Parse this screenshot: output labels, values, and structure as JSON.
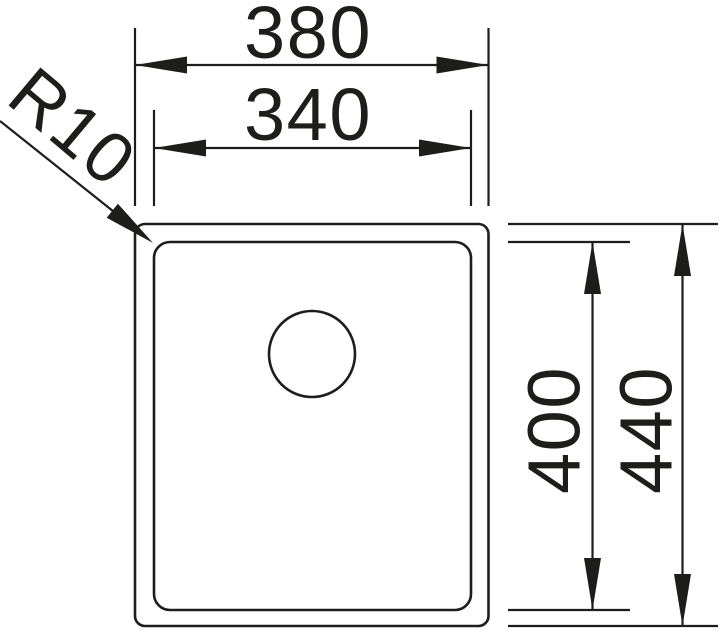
{
  "diagram": {
    "name": "sink-cutout-dimension-drawing",
    "dimensions": {
      "outer_width": "380",
      "inner_width": "340",
      "inner_height": "400",
      "outer_height": "440",
      "corner_radius": "R10"
    },
    "colors": {
      "ink": "#1d1d1b",
      "background": "#ffffff"
    }
  }
}
